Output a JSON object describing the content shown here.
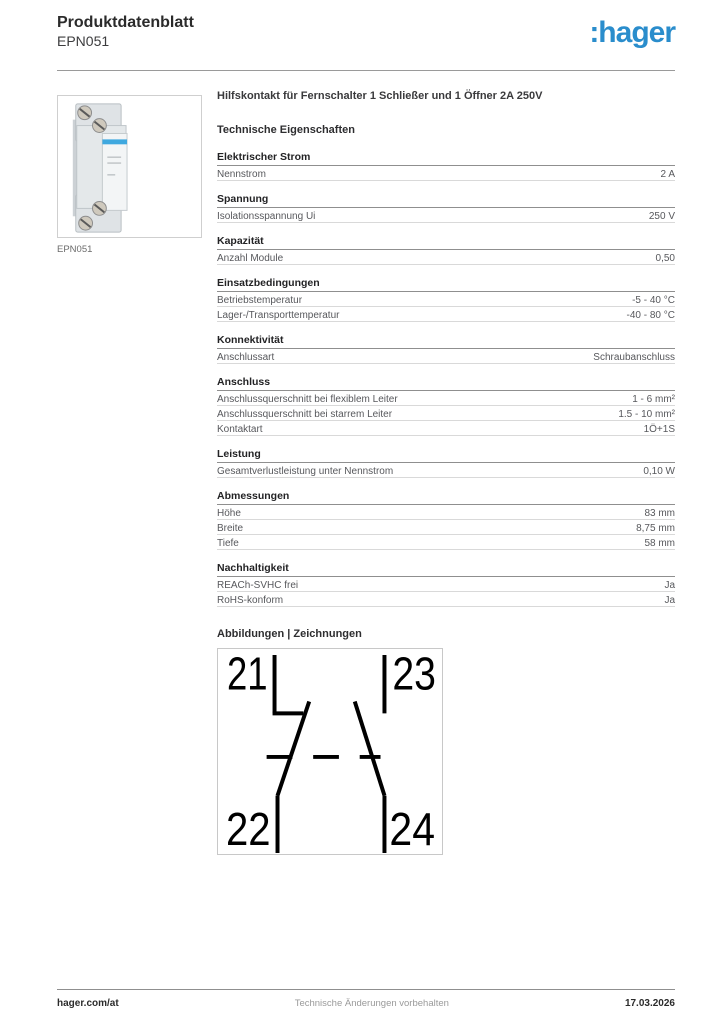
{
  "header": {
    "doc_type": "Produktdatenblatt",
    "product_ref": "EPN051",
    "logo_text": ":hager",
    "brand_color": "#2a8dcc"
  },
  "product": {
    "image_caption": "EPN051",
    "title": "Hilfskontakt für Fernschalter 1 Schließer und 1 Öffner 2A 250V",
    "stripe_color": "#3fa8df"
  },
  "tech_heading": "Technische Eigenschaften",
  "sections": [
    {
      "title": "Elektrischer Strom",
      "rows": [
        {
          "label": "Nennstrom",
          "value": "2 A"
        }
      ]
    },
    {
      "title": "Spannung",
      "rows": [
        {
          "label": "Isolationsspannung Ui",
          "value": "250 V"
        }
      ]
    },
    {
      "title": "Kapazität",
      "rows": [
        {
          "label": "Anzahl Module",
          "value": "0,50"
        }
      ]
    },
    {
      "title": "Einsatzbedingungen",
      "rows": [
        {
          "label": "Betriebstemperatur",
          "value": "-5 - 40 °C"
        },
        {
          "label": "Lager-/Transporttemperatur",
          "value": "-40 - 80 °C"
        }
      ]
    },
    {
      "title": "Konnektivität",
      "rows": [
        {
          "label": "Anschlussart",
          "value": "Schraubanschluss"
        }
      ]
    },
    {
      "title": "Anschluss",
      "rows": [
        {
          "label": "Anschlussquerschnitt bei flexiblem Leiter",
          "value": "1 - 6 mm²"
        },
        {
          "label": "Anschlussquerschnitt bei starrem Leiter",
          "value": "1.5 - 10 mm²"
        },
        {
          "label": "Kontaktart",
          "value": "1Ö+1S"
        }
      ]
    },
    {
      "title": "Leistung",
      "rows": [
        {
          "label": "Gesamtverlustleistung unter Nennstrom",
          "value": "0,10 W"
        }
      ]
    },
    {
      "title": "Abmessungen",
      "rows": [
        {
          "label": "Höhe",
          "value": "83 mm"
        },
        {
          "label": "Breite",
          "value": "8,75 mm"
        },
        {
          "label": "Tiefe",
          "value": "58 mm"
        }
      ]
    },
    {
      "title": "Nachhaltigkeit",
      "rows": [
        {
          "label": "REACh-SVHC frei",
          "value": "Ja"
        },
        {
          "label": "RoHS-konform",
          "value": "Ja"
        }
      ]
    }
  ],
  "figures": {
    "heading": "Abbildungen | Zeichnungen",
    "terminals": {
      "tl": "21",
      "tr": "23",
      "bl": "22",
      "br": "24"
    }
  },
  "footer": {
    "website": "hager.com/at",
    "notice": "Technische Änderungen vorbehalten",
    "date": "17.03.2026"
  }
}
